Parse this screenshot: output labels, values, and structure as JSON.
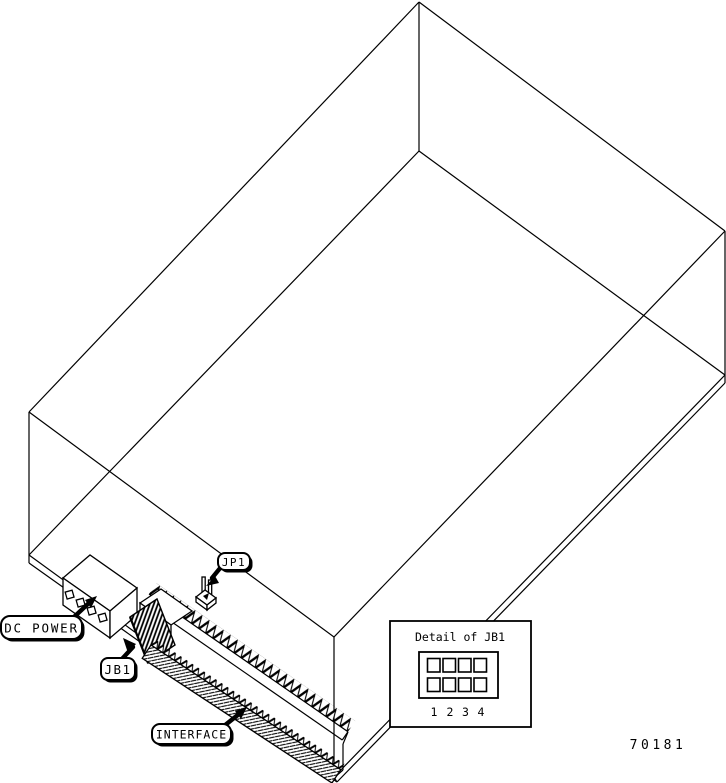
{
  "figure": {
    "kind": "isometric wireframe drawing of a drive chassis with rear connectors",
    "background": "#ffffff",
    "line_color": "#000000",
    "part_number": "70181"
  },
  "callouts": {
    "dc_power": "DC POWER",
    "jb1": "JB1",
    "jp1": "JP1",
    "interface": "INTERFACE"
  },
  "detail_box": {
    "title": "Detail of JB1",
    "rows": 2,
    "columns": 4,
    "column_numbers": [
      "1",
      "2",
      "3",
      "4"
    ]
  }
}
